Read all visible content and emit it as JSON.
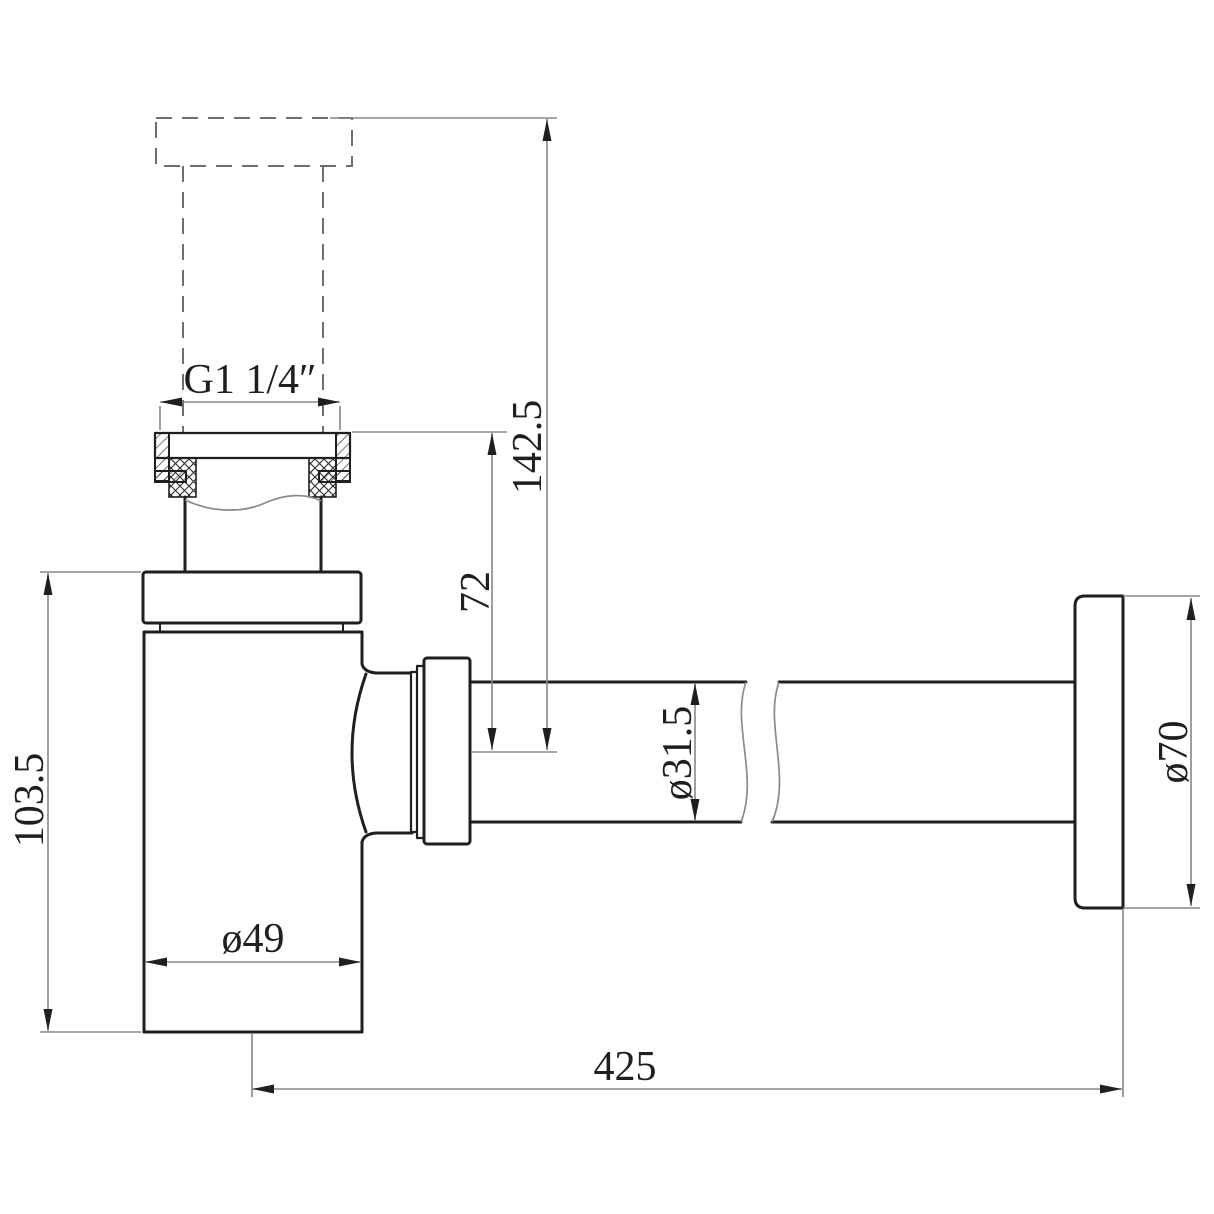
{
  "drawing": {
    "title": "Bottle trap with outlet pipe and wall escutcheon — dimensioned side elevation",
    "labels": {
      "thread_size": "G1 1/4″",
      "total_height": "142.5",
      "inlet_to_outlet_center": "72",
      "body_height": "103.5",
      "body_diameter": "ø49",
      "outlet_pipe_diameter": "ø31.5",
      "escutcheon_diameter": "ø70",
      "horizontal_reach": "425"
    },
    "colors": {
      "object_line": "#1f1f1f",
      "dim_line": "#878787",
      "dash_line": "#6e6e6e",
      "break_line": "#8a8a8a",
      "text_color": "#1f1f1f",
      "background": "#ffffff"
    }
  }
}
